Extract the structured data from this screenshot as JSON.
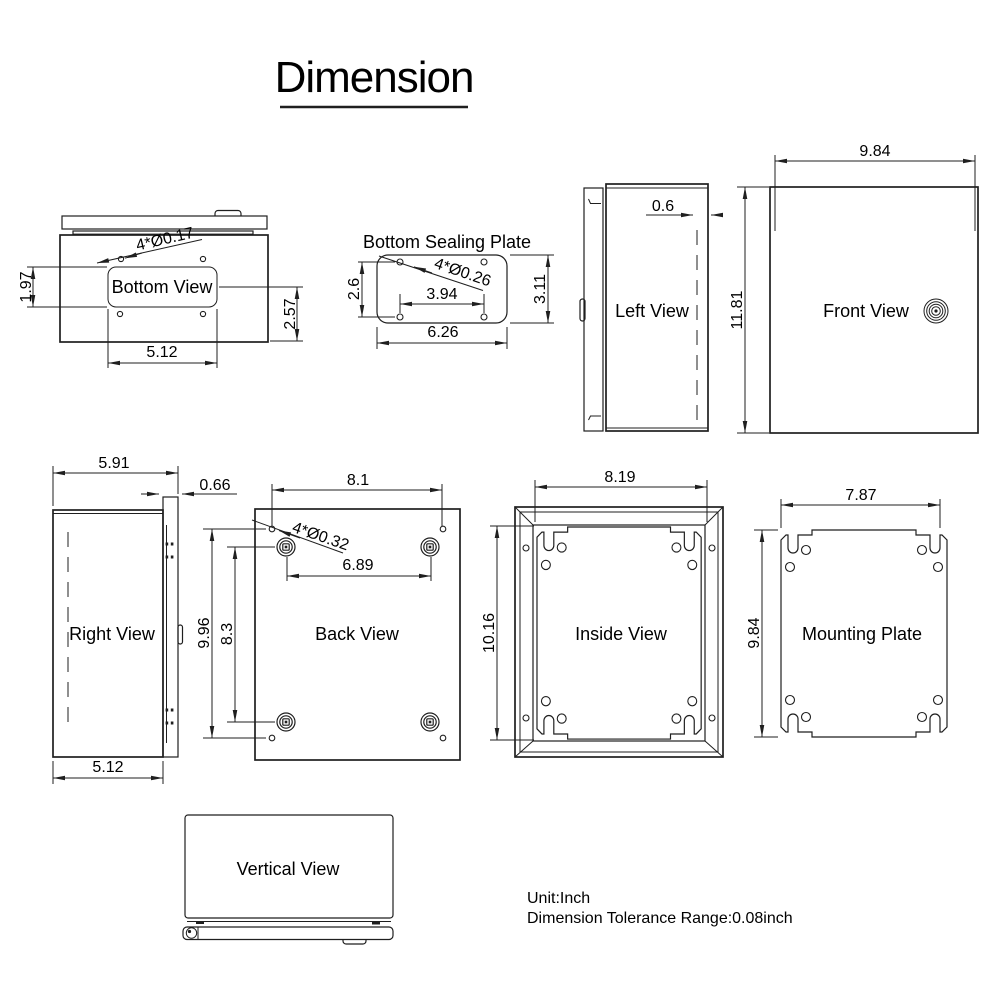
{
  "title": "Dimension",
  "colors": {
    "ink": "#1f1f1f",
    "background": "#ffffff"
  },
  "views": {
    "bottom_view": {
      "label": "Bottom View",
      "dims": {
        "holes_note": "4*Ø0.17",
        "height_left": "1.97",
        "height_right": "2.57",
        "width": "5.12"
      }
    },
    "bottom_sealing_plate": {
      "label": "Bottom Sealing Plate",
      "dims": {
        "holes_note": "4*Ø0.26",
        "height_left": "2.6",
        "height_right": "3.11",
        "hole_spacing": "3.94",
        "width": "6.26"
      }
    },
    "left_view": {
      "label": "Left View",
      "dims": {
        "lid_depth": "0.6"
      }
    },
    "front_view": {
      "label": "Front View",
      "dims": {
        "width": "9.84",
        "height": "11.81"
      }
    },
    "right_view": {
      "label": "Right View",
      "dims": {
        "depth_total": "5.91",
        "lid_depth": "0.66",
        "depth_body": "5.12"
      }
    },
    "back_view": {
      "label": "Back View",
      "dims": {
        "holes_note": "4*Ø0.32",
        "hole_width": "8.1",
        "boss_width": "6.89",
        "hole_height": "9.96",
        "boss_height": "8.3"
      }
    },
    "inside_view": {
      "label": "Inside View",
      "dims": {
        "width": "8.19",
        "height": "10.16"
      }
    },
    "mounting_plate": {
      "label": "Mounting Plate",
      "dims": {
        "width": "7.87",
        "height": "9.84"
      }
    },
    "vertical_view": {
      "label": "Vertical View"
    }
  },
  "footer": {
    "unit": "Unit:Inch",
    "tolerance": "Dimension Tolerance Range:0.08inch"
  }
}
